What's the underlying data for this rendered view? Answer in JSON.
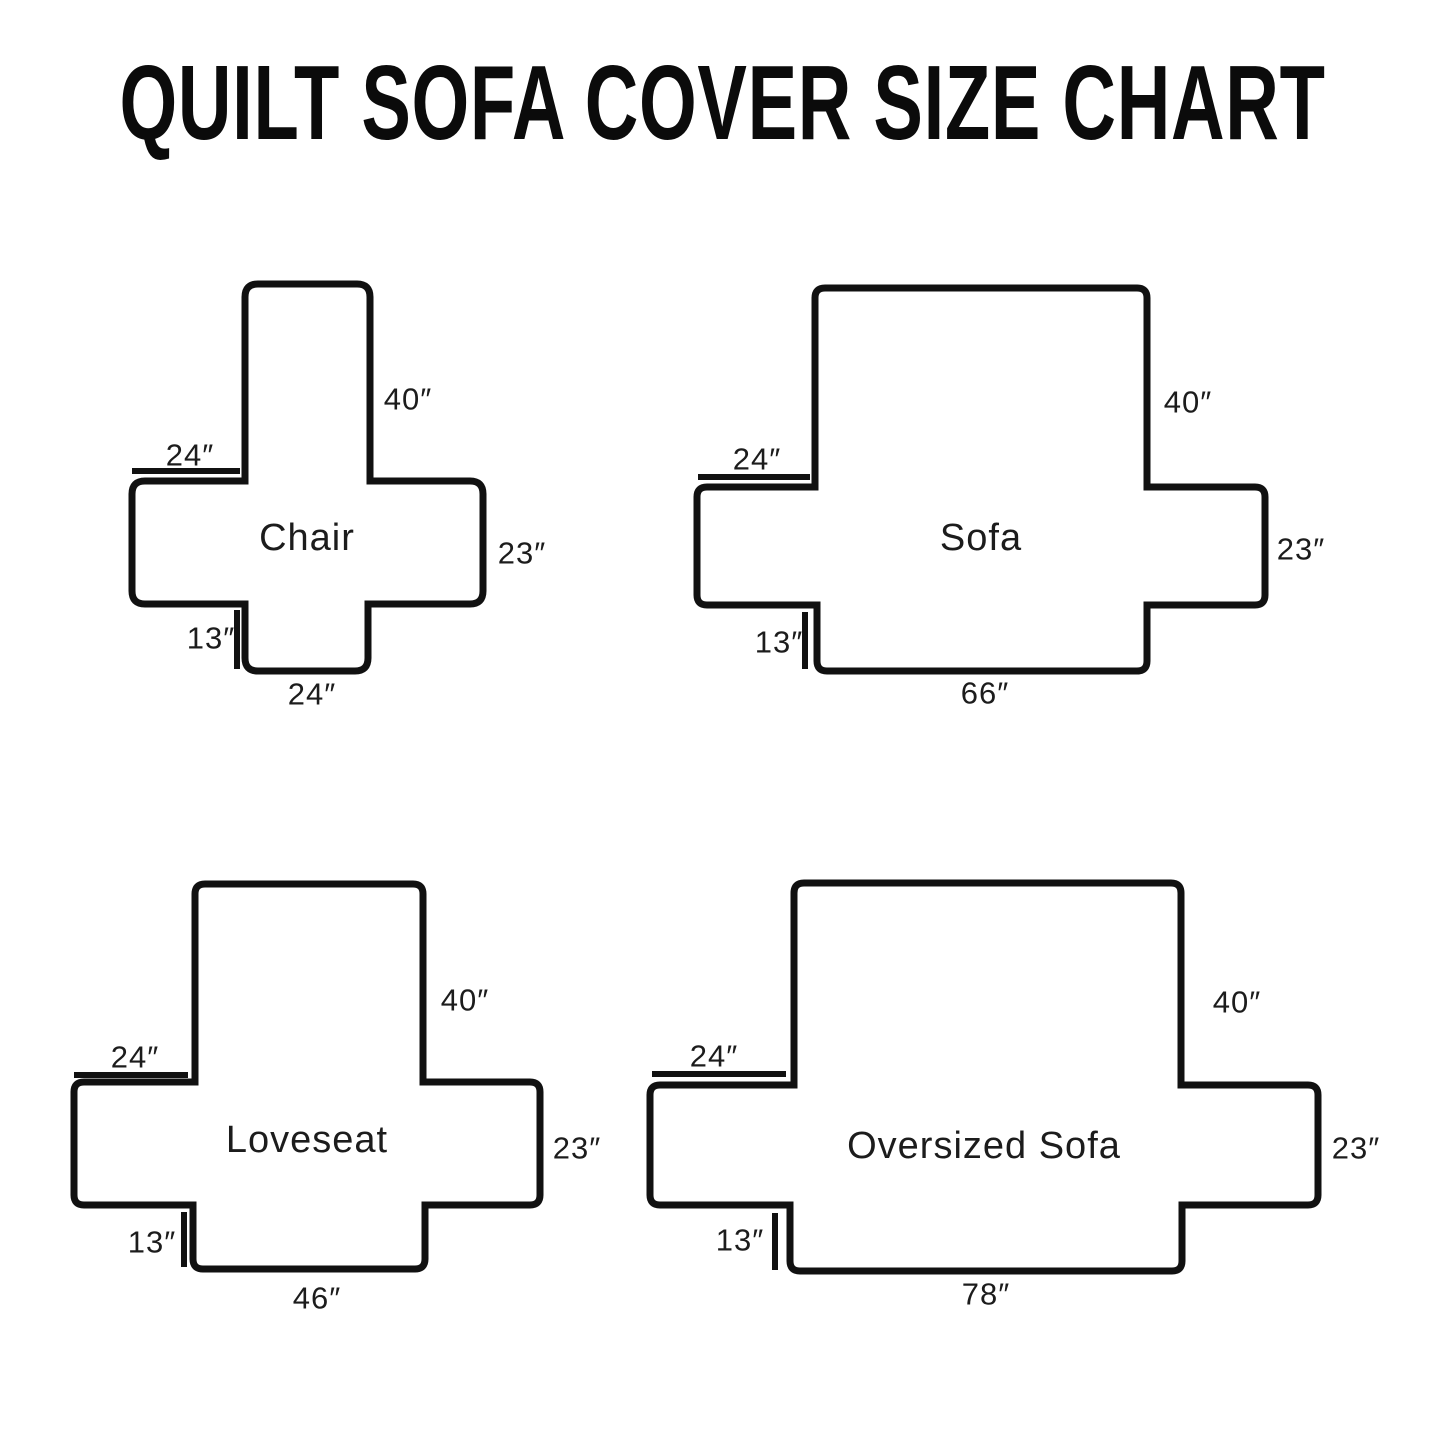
{
  "title": "QUILT SOFA COVER SIZE CHART",
  "colors": {
    "background": "#ffffff",
    "line": "#111111",
    "text": "#1c1c1c"
  },
  "diagrams": {
    "chair": {
      "name": "Chair",
      "back_height": "40″",
      "arm_top_width": "24″",
      "side_depth": "23″",
      "front_skirt_height": "13″",
      "bottom_width": "24″"
    },
    "sofa": {
      "name": "Sofa",
      "back_height": "40″",
      "arm_top_width": "24″",
      "side_depth": "23″",
      "front_skirt_height": "13″",
      "bottom_width": "66″"
    },
    "loveseat": {
      "name": "Loveseat",
      "back_height": "40″",
      "arm_top_width": "24″",
      "side_depth": "23″",
      "front_skirt_height": "13″",
      "bottom_width": "46″"
    },
    "oversized_sofa": {
      "name": "Oversized Sofa",
      "back_height": "40″",
      "arm_top_width": "24″",
      "side_depth": "23″",
      "front_skirt_height": "13″",
      "bottom_width": "78″"
    }
  }
}
